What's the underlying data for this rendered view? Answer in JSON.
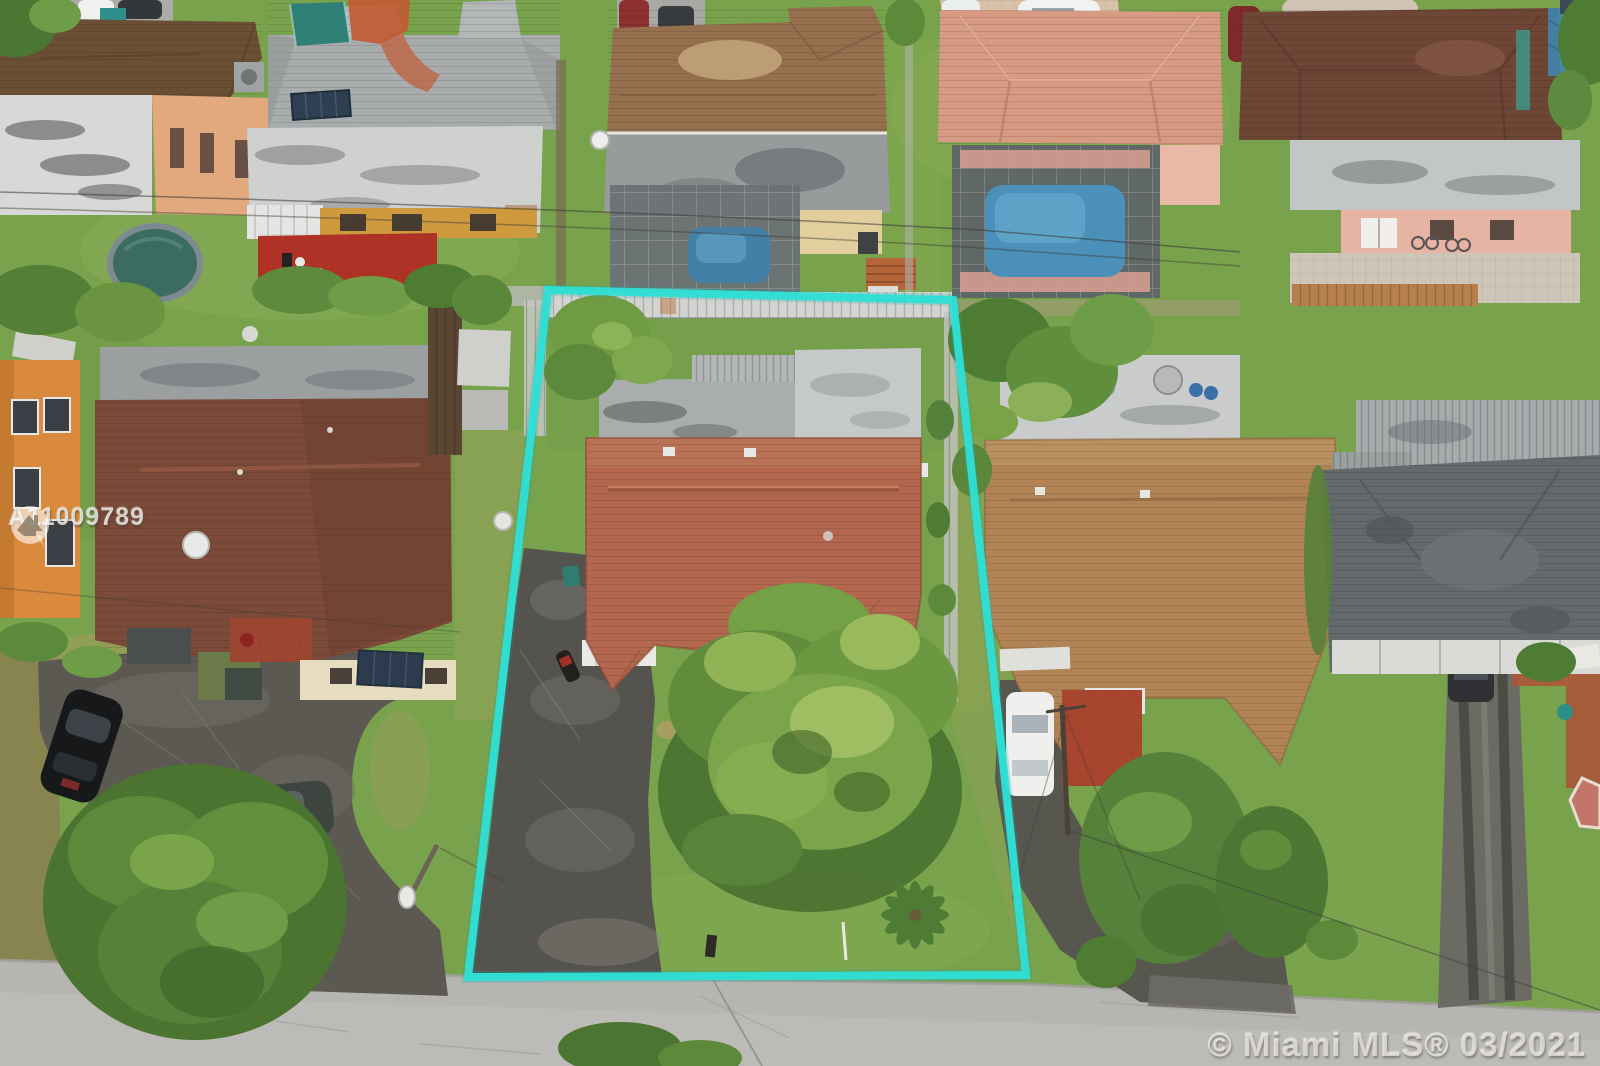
{
  "meta": {
    "type": "aerial-drone-photo",
    "description": "Overhead aerial photo of a residential neighborhood; the subject single-family lot is outlined in turquoise between neighboring homes, with a street along the bottom.",
    "width_px": 1600,
    "height_px": 1066
  },
  "watermarks": {
    "listing_id": "A11009789",
    "mls_credit": "© Miami MLS® 03/2021",
    "logo_icon": "mls-house-logo"
  },
  "boundary": {
    "label": "subject property boundary",
    "points": "548,290 953,300 1026,975 468,977",
    "color": "#2FDFD5"
  },
  "colors": {
    "boundary": "#2FDFD5",
    "watermark_text": "#EEEDEA",
    "grass_base": "#79A24D",
    "street_asphalt": "#B6B5B1",
    "driveway_asphalt": "#55544E",
    "subject_roof_terracotta": "#B2674E",
    "subject_flat_roof": "#C6C9C9",
    "left_neighbor_roof_maroon": "#7C4A38",
    "right_neighbor_roof_tan": "#B28455",
    "pool_water_blue": "#4A90B8",
    "rear_fence_white": "#D2D4D2"
  },
  "scene": {
    "subject_lot_features": [
      "terracotta-tile-roof-house",
      "weathered-flat-roof-rear-section",
      "asphalt-driveway",
      "parked-motorcycle",
      "large-front-yard-tree",
      "palm-tree",
      "white-rear-fence",
      "backyard-tree",
      "mailbox"
    ],
    "surroundings": [
      "street-bottom",
      "left-neighbor-maroon-roof-house",
      "orange-two-story-house",
      "parked-black-car",
      "parked-gray-car",
      "street-lamp",
      "right-neighbor-tan-roof-house",
      "white-parked-car",
      "red-tile-patio",
      "far-right-dark-roof-house",
      "long-driveway-with-suv",
      "rear-neighbor-houses",
      "screened-pools",
      "above-ground-pool",
      "paver-driveway-white-suv",
      "power-lines",
      "utility-pole"
    ]
  }
}
